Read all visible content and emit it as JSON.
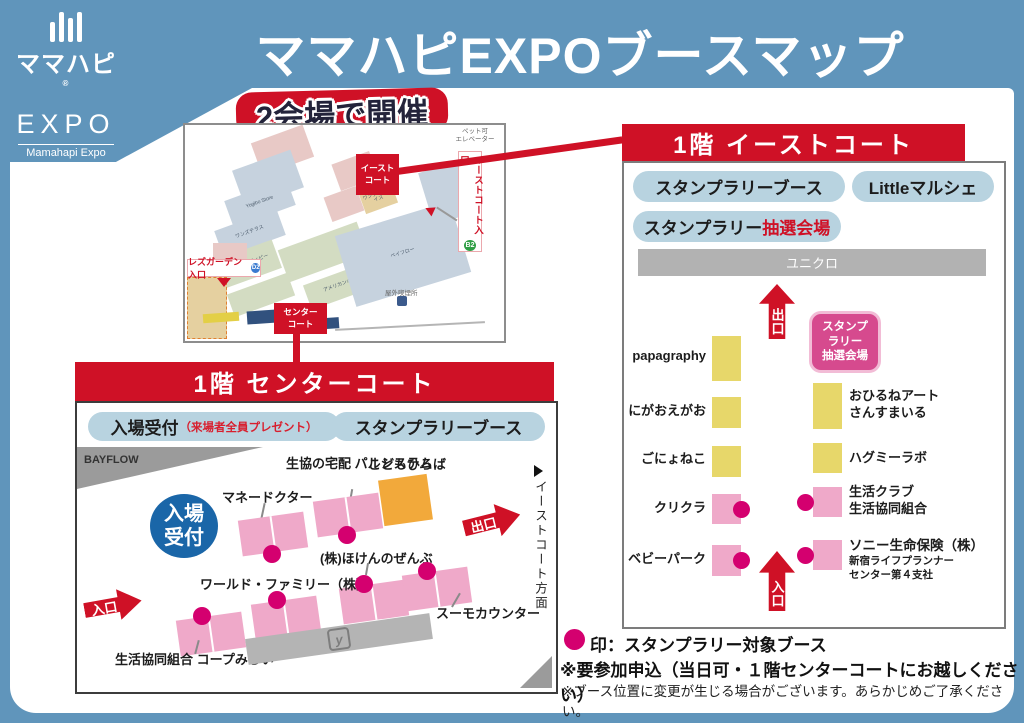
{
  "header": {
    "title": "ママハピEXPOブースマップ",
    "badge": "2会場で開催",
    "logo": {
      "name_jp": "ママハピ",
      "reg": "®",
      "name_en": "EXPO",
      "sub": "Mamahapi Expo"
    }
  },
  "colors": {
    "background_blue": "#6095bb",
    "red": "#cf1126",
    "pill_blue": "#b8d3e0",
    "stamp_magenta": "#d4006f",
    "booth_pink": "#efa9c9",
    "booth_yellow": "#e7d76a",
    "kids_orange": "#f2a93b",
    "reception_blue": "#1a66a8"
  },
  "floor_map": {
    "east_box": "イースト\nコート",
    "center_box": "センター\nコート",
    "rose_entrance": "レズガーデン入口",
    "d2": "D2",
    "east_entrance": "イーストコート入口",
    "b2": "B2",
    "pet_elevator": "ペット可\nエレベーター",
    "smoking": "屋外喫煙所",
    "stores": [
      "Yogibo Store",
      "ワンズテラス",
      "チャオパニックティピー",
      "ベイフロー",
      "アメリカンホリック",
      "ワンダープライス"
    ]
  },
  "east_court": {
    "header": "1階 イーストコート",
    "pill_stamp": "スタンプラリーブース",
    "pill_little": "Littleマルシェ",
    "pill_raffle_black": "スタンプラリー",
    "pill_raffle_red": "抽選会場",
    "uniqlo": "ユニクロ",
    "exit": "出口",
    "entrance": "入口",
    "raffle_badge": "スタンプ\nラリー\n抽選会場",
    "left_booths": [
      {
        "label": "papagraphy"
      },
      {
        "label": "にがおえがお"
      },
      {
        "label": "ごにょねこ"
      },
      {
        "label": "クリクラ"
      },
      {
        "label": "ベビーパーク"
      }
    ],
    "right_booths": [
      {
        "label": "おひるねアート\nさんすまいる"
      },
      {
        "label": "ハグミーラボ"
      },
      {
        "label": "生活クラブ\n生活協同組合"
      },
      {
        "label": "ソニー生命保険（株）",
        "sub": "新宿ライフプランナー\nセンター第４支社"
      }
    ]
  },
  "center_court": {
    "header": "1階 センターコート",
    "pill_reception_main": "入場受付",
    "pill_reception_note": "（来場者全員プレゼント）",
    "pill_stamp": "スタンプラリーブース",
    "bayflow": "BAYFLOW",
    "direction": "イーストコート方面",
    "reception_circle": "入場\n受付",
    "kids_area": "こどもひろば",
    "exit": "出口",
    "entrance": "入口",
    "escalator_icon": "y",
    "booth_labels": {
      "money_doctor": "マネードクター",
      "palsystem": "生協の宅配\nパルシステム",
      "hoken": "(株)ほけんのぜんぶ",
      "world_family": "ワールド・ファミリー（株）",
      "suumo": "スーモカウンター",
      "coop": "生活協同組合\nコープみらい"
    }
  },
  "legend": {
    "stamp_note": "印：スタンプラリー対象ブース",
    "note1": "※要参加申込（当日可・１階センターコートにお越しください）",
    "note2": "※ブース位置に変更が生じる場合がございます。あらかじめご了承ください。"
  }
}
